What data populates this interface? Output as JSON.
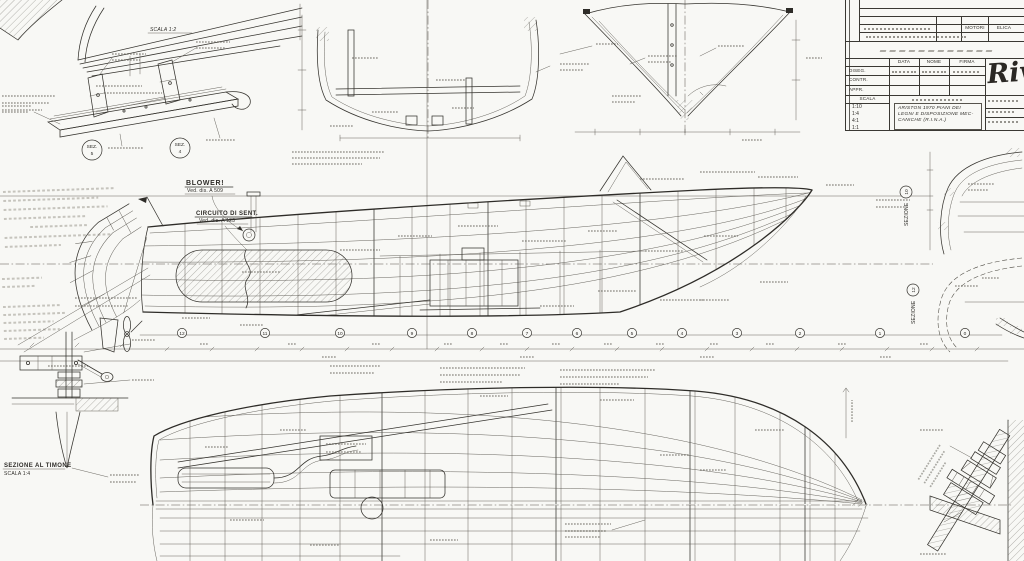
{
  "sheet": {
    "background": "#f8f8f5",
    "ink": "#2e2c28"
  },
  "labels": {
    "blower": "BLOWER!",
    "blower_ref": "Ved. dis. A 509",
    "bilge": "CIRCUITO DI SENT.",
    "bilge_ref": "Ved. dis. A 123",
    "detail_scale": "SCALA 1:2",
    "rudder_section": "SEZIONE AL TIMONE",
    "rudder_scale": "SCALA 1:4",
    "sezione": "SEZIONE",
    "sezione10_num": "10",
    "sezione12_num": "12",
    "sez_marker": "SEZ.",
    "sez5_num": "5",
    "sez4_num": "4"
  },
  "profile": {
    "stations": [
      "12",
      "11",
      "10",
      "9",
      "8",
      "7",
      "6",
      "5",
      "4",
      "3",
      "2",
      "1",
      "0"
    ]
  },
  "title_block": {
    "logo": "Riva",
    "header_cols": [
      "DATA",
      "NOME",
      "FIRMA"
    ],
    "row_labels": [
      "DISEG.",
      "CONTR.",
      "APPR."
    ],
    "scala_label": "SCALA",
    "scales": [
      "1:10",
      "1:4",
      "4:1",
      "1:1"
    ],
    "rev_cells": [
      "MOTORI",
      "ELICA"
    ],
    "title_line1": "ARISTON 1970  PIANI DEI",
    "title_line2": "LEGNI E DISPOSIZIONE MEC-",
    "title_line3": "CANICHE  (R.I.N.A.)"
  }
}
